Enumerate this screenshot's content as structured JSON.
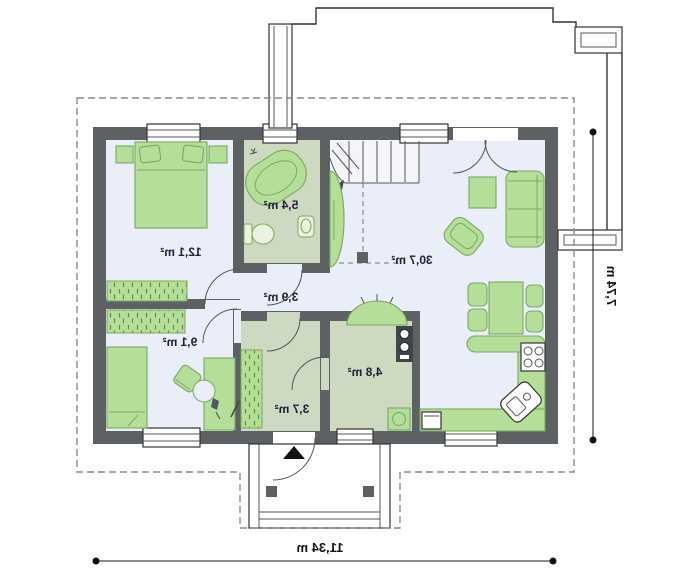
{
  "page": {
    "type": "architectural floor plan (ground floor), rendered mirror-flipped",
    "background": "#ffffff",
    "text_mirrored": true
  },
  "rooms": [
    {
      "id": "bedroom-1",
      "area_label": "12,1 m²"
    },
    {
      "id": "bathroom",
      "area_label": "5,4 m²"
    },
    {
      "id": "hall",
      "area_label": "3,9 m²"
    },
    {
      "id": "living-room",
      "area_label": "30,7 m²"
    },
    {
      "id": "bedroom-2",
      "area_label": "9,1 m²"
    },
    {
      "id": "entry-hall",
      "area_label": "3,7 m²"
    },
    {
      "id": "utility-room",
      "area_label": "4,8 m²"
    }
  ],
  "dimensions": {
    "width_label": "11,34 m",
    "height_label": "7,74 m"
  },
  "icons": {
    "entrance_arrow": "solid black triangle pointing up at main entrance",
    "door_swing": "quarter-circle arc",
    "stairs": "winder staircase with treads and dashed projection",
    "window": "white bar with glazing lines in wall",
    "wardrobe": "green rectangle with vertical hatch strokes"
  },
  "colors": {
    "wall": "#5d6163",
    "room_floor": "#e9eef8",
    "wet_floor": "#cdd9c0",
    "furniture": "#b5df99",
    "furniture_stroke": "#7aa85f",
    "outline": "#333333",
    "dash": "#8a8a8a",
    "text": "#20203a"
  }
}
